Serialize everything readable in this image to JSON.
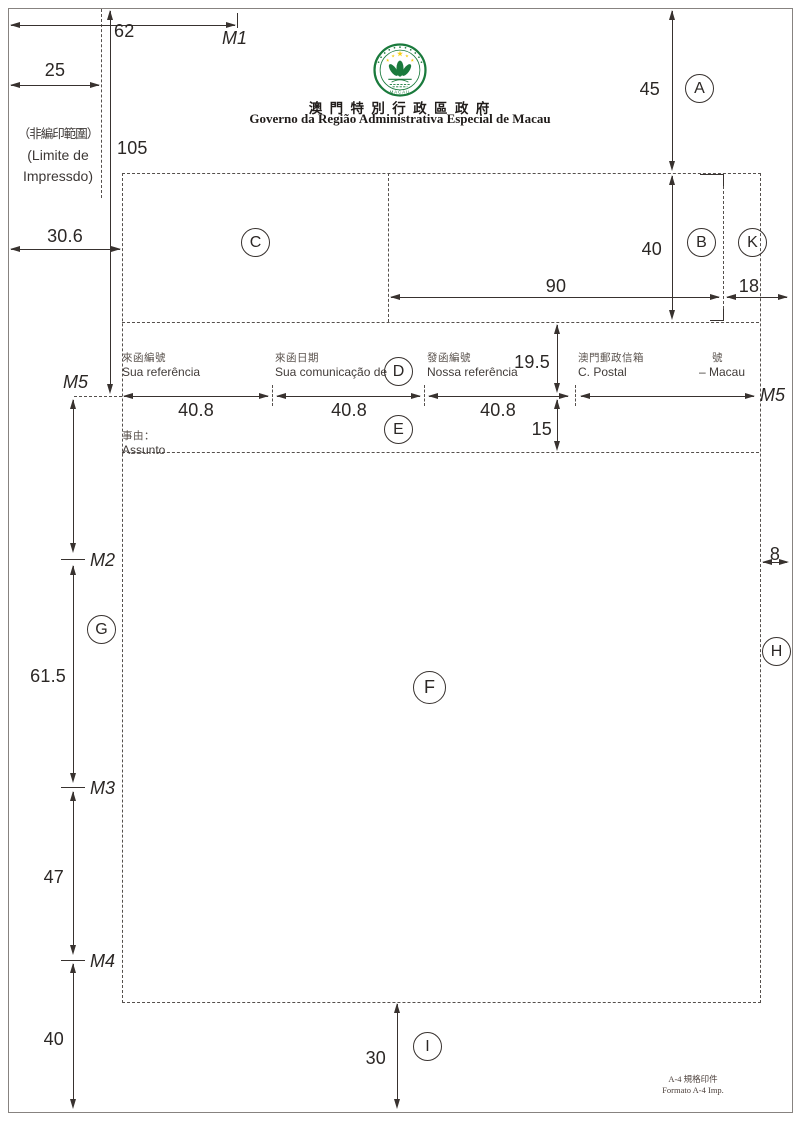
{
  "header": {
    "title_zh": "澳 門 特 別 行 政 區 政 府",
    "title_pt": "Governo da Região Administrativa Especial de Macau",
    "emblem": {
      "name": "macau-sar-emblem",
      "green": "#1a7a3c",
      "star_yellow": "#f6d013",
      "label": "MACAU"
    }
  },
  "annotations": {
    "non_print_area": {
      "line1": "（非編印範圍）",
      "line2": "(Limite de",
      "line3": "Impressdo)"
    },
    "format_note": {
      "line1": "A-4 規格印件",
      "line2": "Formato A-4 Imp."
    }
  },
  "markers": {
    "m1": "M1",
    "m2": "M2",
    "m3": "M3",
    "m4": "M4",
    "m5_left": "M5",
    "m5_right": "M5"
  },
  "regions": {
    "a": "A",
    "b": "B",
    "c": "C",
    "d": "D",
    "e": "E",
    "f": "F",
    "g": "G",
    "h": "H",
    "i": "I",
    "k": "K"
  },
  "dims": {
    "d62": "62",
    "d25": "25",
    "d105": "105",
    "d30_6": "30.6",
    "d45": "45",
    "d40_box": "40",
    "d90": "90",
    "d18": "18",
    "d19_5": "19.5",
    "d15": "15",
    "d40_8a": "40.8",
    "d40_8b": "40.8",
    "d40_8c": "40.8",
    "d8": "8",
    "d61_5": "61.5",
    "d47": "47",
    "d40_left": "40",
    "d30": "30"
  },
  "fields": [
    {
      "zh": "來函編號",
      "pt": "Sua referência"
    },
    {
      "zh": "來函日期",
      "pt": "Sua comunicação de"
    },
    {
      "zh": "發函編號",
      "pt": "Nossa referência"
    },
    {
      "zh": "澳門郵政信箱",
      "pt": "C. Postal"
    },
    {
      "zh": "號",
      "pt": "– Macau"
    }
  ],
  "subject": {
    "zh": "事由：",
    "pt": "Assunto"
  }
}
